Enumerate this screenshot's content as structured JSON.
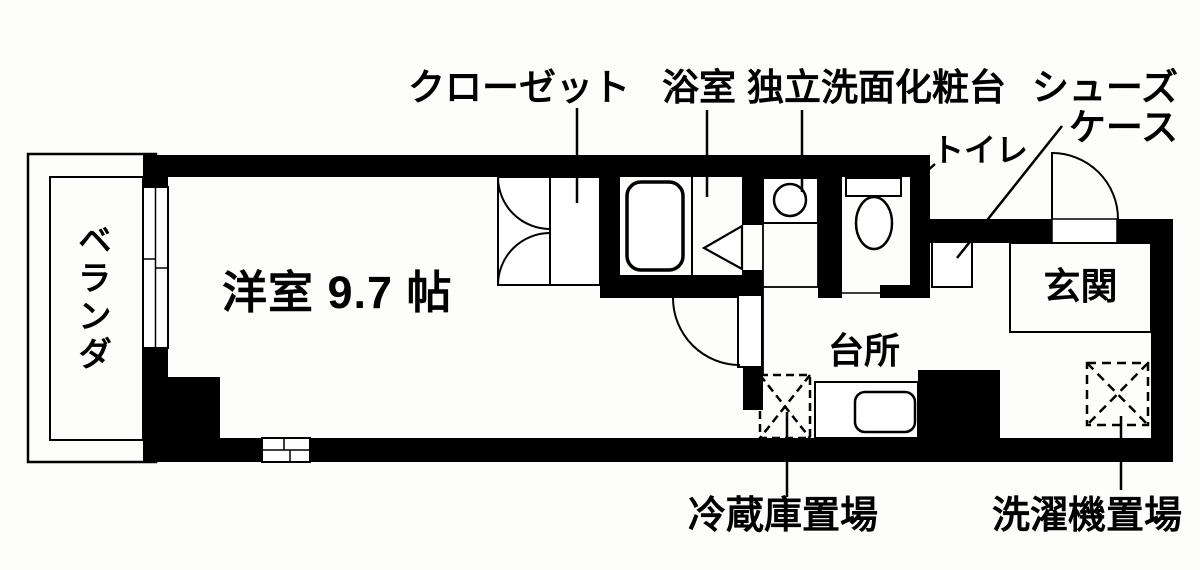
{
  "title": "ワンルーム間取り図",
  "labels": {
    "veranda": "ベランダ",
    "main_room": "洋室 9.7 帖",
    "closet": "クローゼット",
    "bathroom": "浴室",
    "vanity": "独立洗面化粧台",
    "shoe_case": {
      "line1": "シューズ",
      "line2": "ケース"
    },
    "toilet": "トイレ",
    "entrance": "玄関",
    "kitchen": "台所",
    "refrigerator_space": "冷蔵庫置場",
    "washing_machine_space": "洗濯機置場"
  },
  "colors": {
    "background": "#fdfdfb",
    "walls": "#000000",
    "lines": "#000000"
  }
}
